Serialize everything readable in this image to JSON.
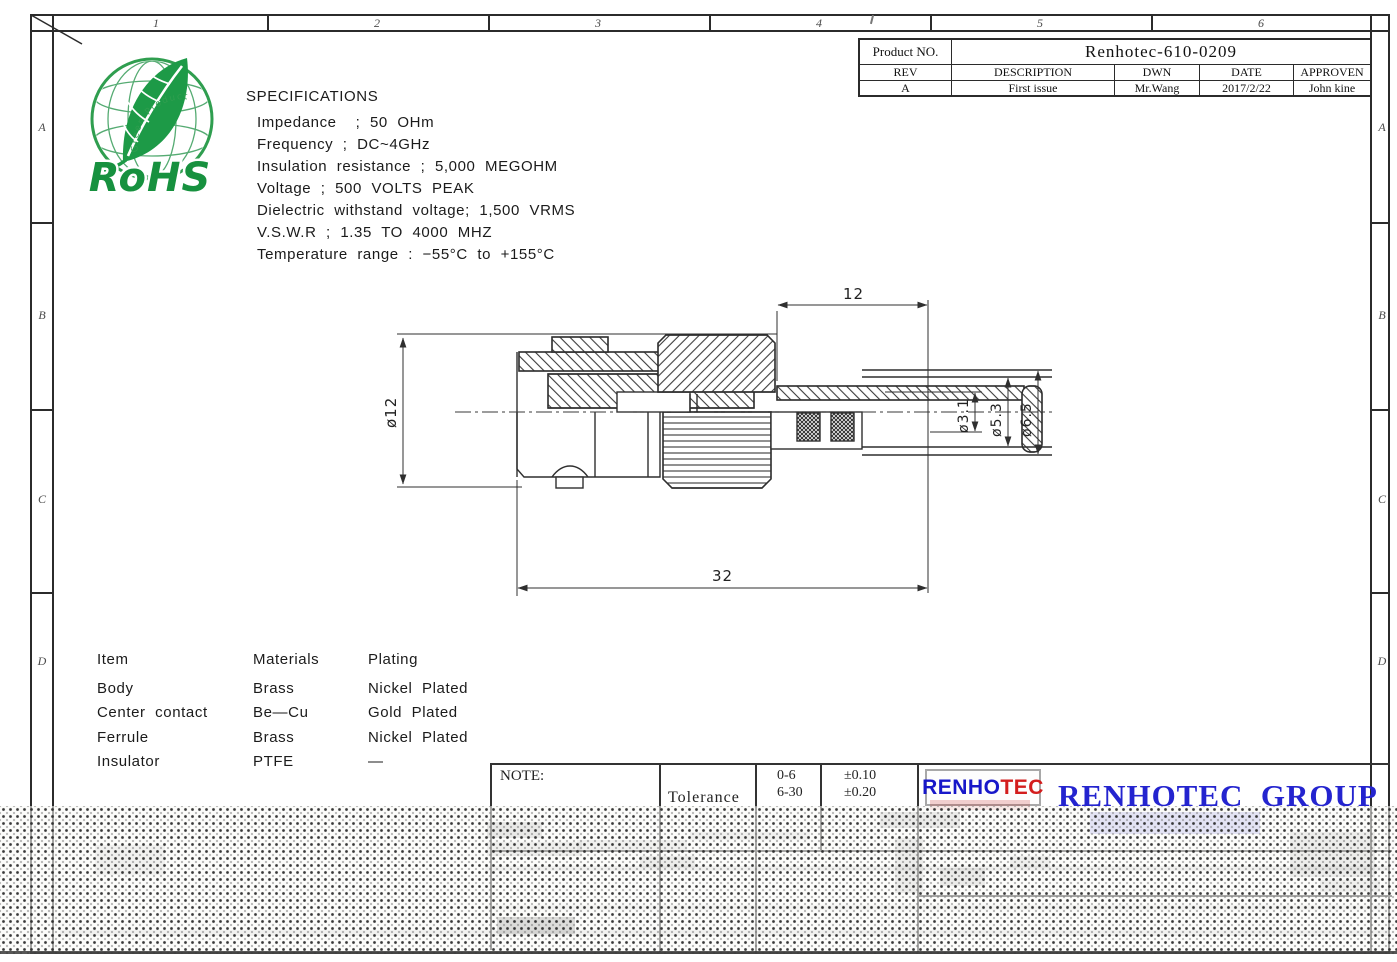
{
  "document": {
    "zones_top": [
      "1",
      "2",
      "3",
      "4",
      "5",
      "6"
    ],
    "zones_side": [
      "A",
      "B",
      "C",
      "D"
    ]
  },
  "title_block": {
    "product_label": "Product NO.",
    "product_value": "Renhotec-610-0209",
    "col_headers": [
      "REV",
      "DESCRIPTION",
      "DWN",
      "DATE",
      "APPROVEN"
    ],
    "revision_row": [
      "A",
      "First issue",
      "Mr.Wang",
      "2017/2/22",
      "John kine"
    ]
  },
  "rohs_logo": {
    "title": "RoHS",
    "curved_text": "Green Product"
  },
  "specifications": {
    "title": "SPECIFICATIONS",
    "lines": [
      "Impedance    ;  50  OHm",
      "Frequency  ;  DC~4GHz",
      "Insulation  resistance  ;  5,000  MEGOHM",
      "Voltage  ;  500  VOLTS  PEAK",
      "Dielectric  withstand  voltage;  1,500  VRMS",
      "V.S.W.R  ;  1.35  TO  4000  MHZ",
      "Temperature  range  :  −55°C  to  +155°C"
    ]
  },
  "materials_table": {
    "headers": [
      "Item",
      "Materials",
      "Plating"
    ],
    "rows": [
      [
        "Body",
        "Brass",
        "Nickel  Plated"
      ],
      [
        "Center  contact",
        "Be—Cu",
        "Gold  Plated"
      ],
      [
        "Ferrule",
        "Brass",
        "Nickel  Plated"
      ],
      [
        "Insulator",
        "PTFE",
        "—"
      ]
    ]
  },
  "drawing": {
    "dim_top": "12",
    "dim_total": "32",
    "dim_body": "ø12",
    "dim_inner": "ø3.1",
    "dim_mid": "ø5.3",
    "dim_outer": "ø6.5"
  },
  "note_block": {
    "note_label": "NOTE:",
    "tolerance_label": "Tolerance",
    "tolerance_rows": [
      [
        "0-6",
        "±0.10"
      ],
      [
        "6-30",
        "±0.20"
      ]
    ]
  },
  "branding": {
    "logo_blue": "RENHO",
    "logo_red": "TEC",
    "group_name": "RENHOTEC  GROUP"
  }
}
